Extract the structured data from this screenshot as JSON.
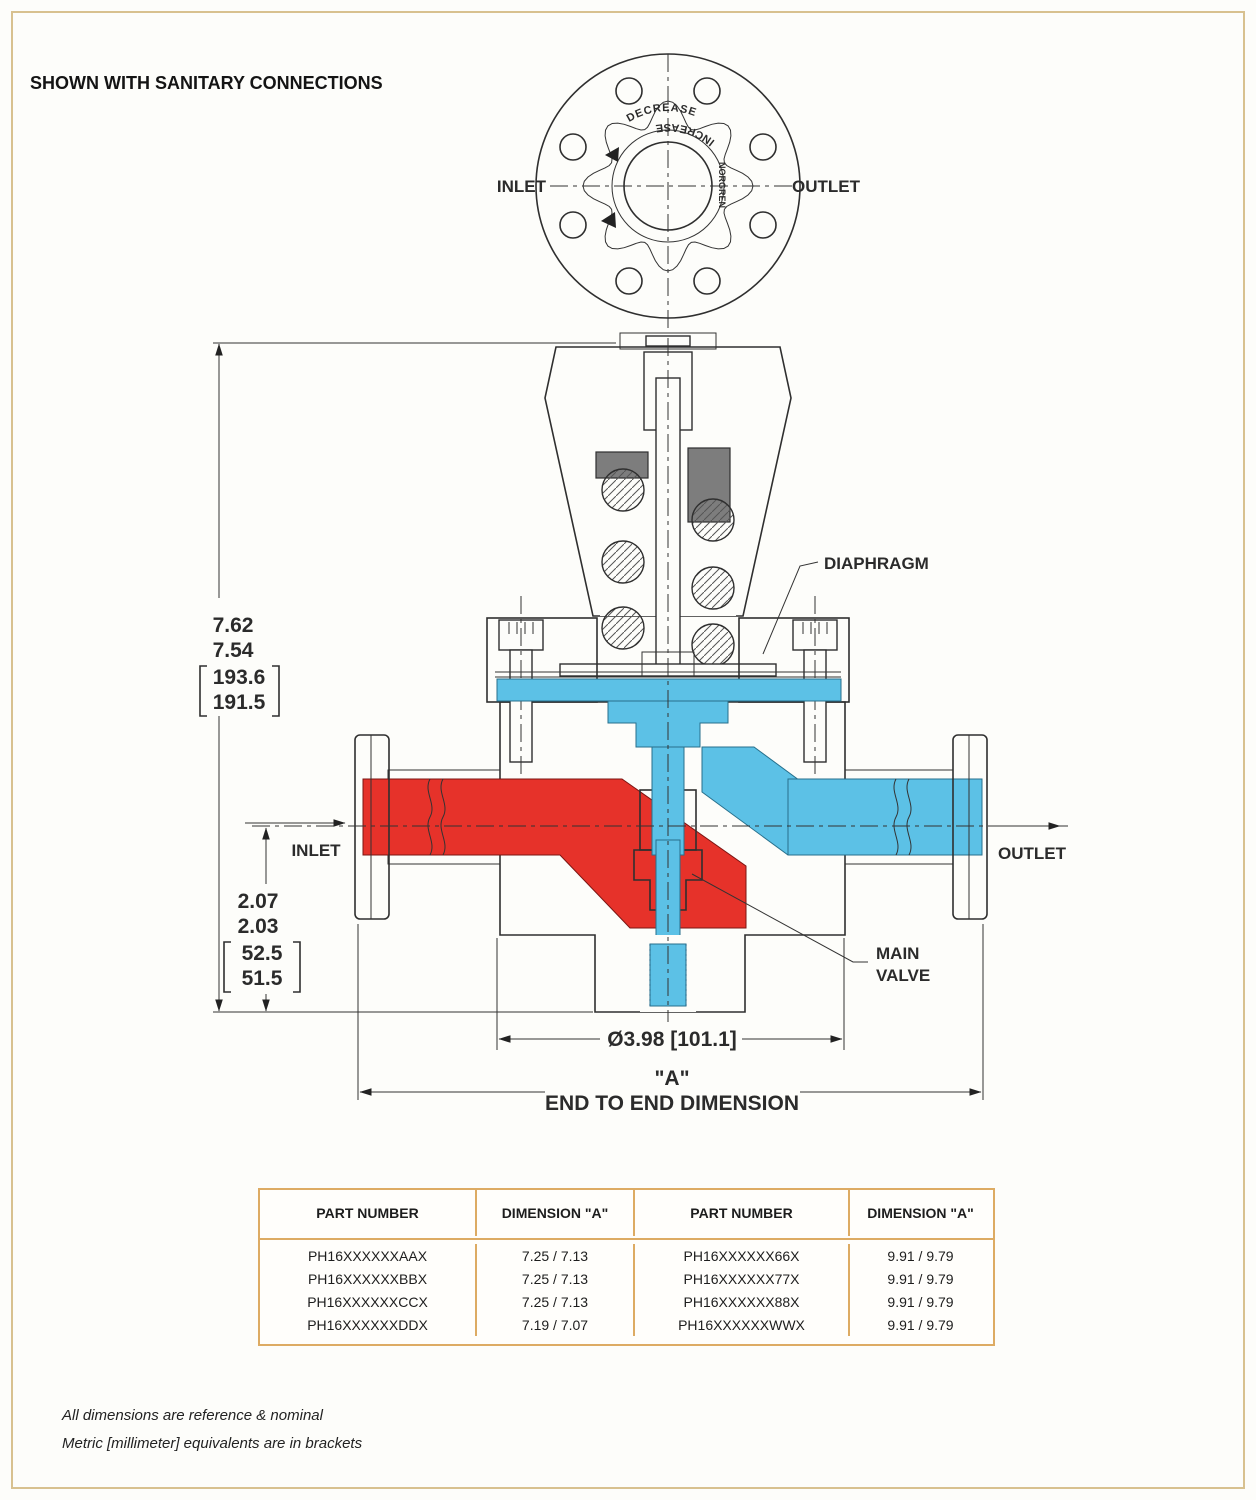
{
  "page": {
    "title": "SHOWN WITH SANITARY CONNECTIONS",
    "notes": [
      "All dimensions are reference & nominal",
      "Metric [millimeter] equivalents are in brackets"
    ]
  },
  "colors": {
    "inlet_red": "#e6322a",
    "outlet_blue": "#5cc1e6",
    "line": "#333333",
    "page_border": "#d8c18f",
    "table_border": "#ddab63"
  },
  "top_view": {
    "inlet_label": "INLET",
    "outlet_label": "OUTLET",
    "decrease_label": "DECREASE",
    "increase_label": "INCREASE",
    "brand_label": "NORGREN"
  },
  "section_view": {
    "inlet_label": "INLET",
    "outlet_label": "OUTLET",
    "diaphragm_label": "DIAPHRAGM",
    "main_valve_line1": "MAIN",
    "main_valve_line2": "VALVE"
  },
  "dimensions": {
    "height_in": [
      "7.62",
      "7.54"
    ],
    "height_mm": [
      "193.6",
      "191.5"
    ],
    "centerline_in": [
      "2.07",
      "2.03"
    ],
    "centerline_mm": [
      "52.5",
      "51.5"
    ],
    "body_diameter": "Ø3.98 [101.1]",
    "a_ref": "\"A\"",
    "a_caption": "END TO END DIMENSION"
  },
  "table": {
    "headers": [
      "PART NUMBER",
      "DIMENSION \"A\"",
      "PART NUMBER",
      "DIMENSION \"A\""
    ],
    "rows": [
      [
        "PH16XXXXXXAAX",
        "7.25 / 7.13",
        "PH16XXXXXX66X",
        "9.91 / 9.79"
      ],
      [
        "PH16XXXXXXBBX",
        "7.25 / 7.13",
        "PH16XXXXXX77X",
        "9.91 / 9.79"
      ],
      [
        "PH16XXXXXXCCX",
        "7.25 / 7.13",
        "PH16XXXXXX88X",
        "9.91 / 9.79"
      ],
      [
        "PH16XXXXXXDDX",
        "7.19 / 7.07",
        "PH16XXXXXXWWX",
        "9.91 / 9.79"
      ]
    ]
  }
}
